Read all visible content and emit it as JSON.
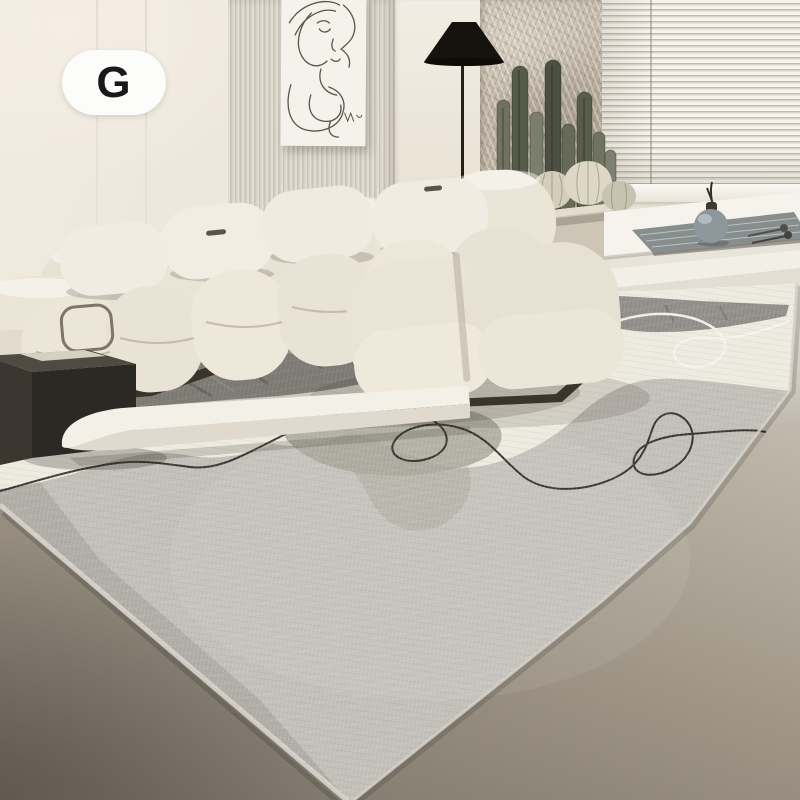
{
  "badge": {
    "label": "G"
  },
  "scene": {
    "type": "product-photo",
    "subject": "Modern grey abstract-print area rug styled in a cream living room",
    "objects": [
      {
        "id": "wall-art",
        "label": "One-line abstract face art print"
      },
      {
        "id": "ribbed-wall-panel",
        "label": "Ribbed wood slat wall panel"
      },
      {
        "id": "floor-lamp",
        "label": "Black cone floor lamp"
      },
      {
        "id": "stone-wall-panel",
        "label": "Textured stone feature wall"
      },
      {
        "id": "window-blinds",
        "label": "Horizontal venetian blinds"
      },
      {
        "id": "cacti",
        "label": "Potted columnar and barrel cacti"
      },
      {
        "id": "window-bench",
        "label": "White window bench with grey mat and round vase"
      },
      {
        "id": "sofa",
        "label": "Cream modular sectional sofa with chaise"
      },
      {
        "id": "side-table",
        "label": "Dark charcoal side table"
      },
      {
        "id": "coffee-table",
        "label": "Low white coffee table"
      },
      {
        "id": "area-rug",
        "label": "Grey abstract area rug with black line art and orange accent circle"
      }
    ]
  },
  "palette": {
    "wall": "#efe9dd",
    "floor_light": "#ddd8cf",
    "floor_dark": "#7f776c",
    "rug_field": "#c2bfb8",
    "rug_dark": "#8d8a84",
    "rug_white": "#edeadf",
    "rug_sage": "#a8a79a",
    "accent_orange": "#e6a53b",
    "line_black": "#2b2924",
    "sofa_cream": "#ebe5d8",
    "lamp_black": "#16130e"
  }
}
